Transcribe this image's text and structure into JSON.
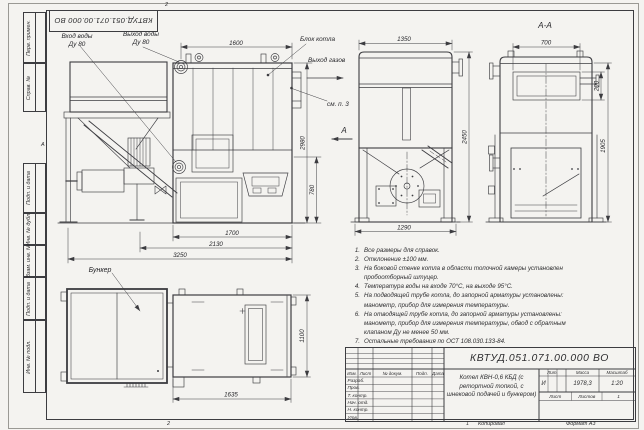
{
  "sheet": {
    "stamp_top": "КВТУД.051.071.00.000 ВО",
    "zone_top": "2",
    "zone_bottom": "2",
    "zone_sheet_no": "1",
    "zone_letter": "А",
    "footer_copy": "Копировал",
    "footer_format": "Формат А3"
  },
  "frame_fields": [
    {
      "label": "Перв. примен."
    },
    {
      "label": "Справ. №"
    },
    {
      "label": "Подп. и дата"
    },
    {
      "label": "Инв. № дубл."
    },
    {
      "label": "Взам. инв. №"
    },
    {
      "label": "Подп. и дата"
    },
    {
      "label": "Инв. № подл."
    }
  ],
  "views": {
    "front": {
      "water_in": "Вход воды",
      "water_in_du": "Ду 80",
      "water_out": "Выход воды",
      "water_out_du": "Ду 80",
      "block_label": "Блок котла",
      "gas_out": "Выход газов",
      "see_note": "см. п. 3",
      "view_arrow": "А",
      "dim_1600": "1600",
      "dim_2980": "2980",
      "dim_780": "780",
      "dim_1700": "1700",
      "dim_2130": "2130",
      "dim_3250": "3250"
    },
    "side": {
      "dim_1350": "1350",
      "dim_2450": "2450",
      "dim_1290": "1290"
    },
    "section": {
      "title": "А-А",
      "dim_700": "700",
      "dim_200": "200",
      "dim_1905": "1905"
    },
    "plan": {
      "bunker_label": "Бункер",
      "dim_1635": "1635",
      "dim_1100": "1100"
    }
  },
  "notes": [
    {
      "n": "1.",
      "t": "Все размеры для справок."
    },
    {
      "n": "2.",
      "t": "Отклонение ±100 мм."
    },
    {
      "n": "3.",
      "t": "На боковой стенке котла в области топочной камеры установлен\nпробоотборный штуцер."
    },
    {
      "n": "4.",
      "t": "Температура воды на входе 70°С, на выходе 95°С."
    },
    {
      "n": "5.",
      "t": "На подводящей трубе котла, до запорной арматуры установлены:\nманометр, прибор для измерения температуры."
    },
    {
      "n": "6.",
      "t": "На отводящей трубе котла, до запорной арматуры установлены:\nманометр, прибор для измерения температуры, обвод с обратным\nклапаном Ду не менее 50 мм."
    },
    {
      "n": "7.",
      "t": "Остальные требования по ОСТ 108.030.133-84."
    }
  ],
  "title_block": {
    "doc_number": "КВТУД.051.071.00.000 ВО",
    "product_name": "Котел КВН-0,6 КБД (с\nретортной топкой, с\nшнековой подачей и бункером)",
    "col_izm": "Изм.",
    "col_list": "Лист",
    "col_doc": "№ докум.",
    "col_sign": "Подп.",
    "col_date": "Дата",
    "row_razrab": "Разраб.",
    "row_prov": "Пров.",
    "row_tkontr": "Т. контр.",
    "row_nachotd": "Нач. отд.",
    "row_nkontr": "Н. контр.",
    "row_utv": "Утв.",
    "lit_label": "Лит.",
    "lit_value": "И",
    "mass_label": "Масса",
    "mass_value": "1978,3",
    "scale_label": "Масштаб",
    "scale_value": "1:20",
    "sheet_label": "Лист",
    "sheets_label": "Листов",
    "sheets_value": "1"
  }
}
